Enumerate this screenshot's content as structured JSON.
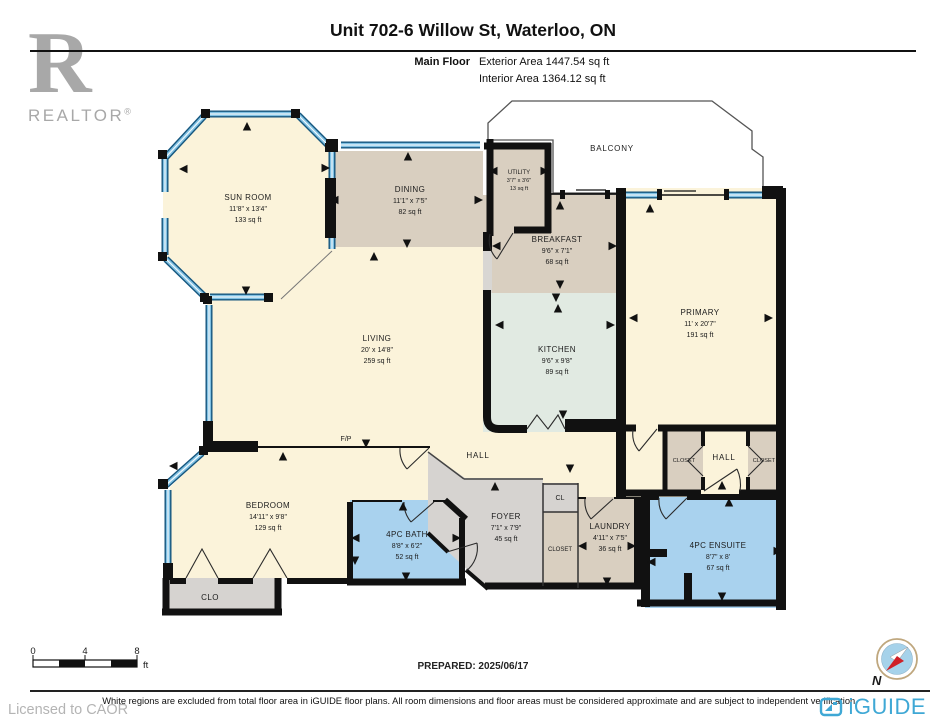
{
  "header": {
    "title": "Unit 702-6 Willow St, Waterloo, ON",
    "floor_label": "Main Floor",
    "exterior_area": "Exterior Area 1447.54 sq ft",
    "interior_area": "Interior Area 1364.12 sq ft"
  },
  "branding": {
    "realtor_logo_letter": "R",
    "realtor_logo_text": "REALTOR",
    "realtor_reg_mark": "®",
    "licensed_text": "Licensed to CAOR",
    "iguide_logo_text": "iGUIDE"
  },
  "rooms": {
    "sun_room": {
      "name": "SUN ROOM",
      "dims": "11'8\" x 13'4\"",
      "area": "133 sq ft"
    },
    "dining": {
      "name": "DINING",
      "dims": "11'1\" x 7'5\"",
      "area": "82 sq ft"
    },
    "utility": {
      "name": "UTILITY",
      "dims": "3'7\" x 3'6\"",
      "area": "13 sq ft"
    },
    "breakfast": {
      "name": "BREAKFAST",
      "dims": "9'6\" x 7'1\"",
      "area": "68 sq ft"
    },
    "primary": {
      "name": "PRIMARY",
      "dims": "11' x 20'7\"",
      "area": "191 sq ft"
    },
    "living": {
      "name": "LIVING",
      "dims": "20' x 14'8\"",
      "area": "259 sq ft"
    },
    "kitchen": {
      "name": "KITCHEN",
      "dims": "9'6\" x 9'8\"",
      "area": "89 sq ft"
    },
    "bedroom": {
      "name": "BEDROOM",
      "dims": "14'11\" x 9'8\"",
      "area": "129 sq ft"
    },
    "bath": {
      "name": "4PC BATH",
      "dims": "8'8\" x 6'2\"",
      "area": "52 sq ft"
    },
    "foyer": {
      "name": "FOYER",
      "dims": "7'1\" x 7'9\"",
      "area": "45 sq ft"
    },
    "laundry": {
      "name": "LAUNDRY",
      "dims": "4'11\" x 7'5\"",
      "area": "36 sq ft"
    },
    "ensuite": {
      "name": "4PC ENSUITE",
      "dims": "8'7\" x 8'",
      "area": "67 sq ft"
    }
  },
  "labels": {
    "balcony": "BALCONY",
    "hall_main": "HALL",
    "hall_bedwing": "HALL",
    "fp": "F/P",
    "cl": "CL",
    "closet_foyer": "CLOSET",
    "closet_hall_left": "CLOSET",
    "closet_hall_right": "CLOSET",
    "clo": "CLO"
  },
  "footer": {
    "scale": {
      "t0": "0",
      "t4": "4",
      "t8": "8",
      "unit": "ft"
    },
    "prepared": "PREPARED: 2025/06/17",
    "compass_north": "N",
    "disclaimer": "White regions are excluded from total floor area in iGUIDE floor plans. All room dimensions and floor areas must be considered approximate and are subject to independent verification."
  },
  "colors": {
    "room_cream": "#FBF3DA",
    "room_tan": "#D9CFC0",
    "room_green": "#E1EAE2",
    "room_blue": "#A9D2EE",
    "room_gray": "#D6D3D0",
    "wall": "#111111",
    "window_blue": "#7FC0E2",
    "iguide_blue": "#3FA8D5",
    "logo_gray": "#A8A8A8"
  }
}
